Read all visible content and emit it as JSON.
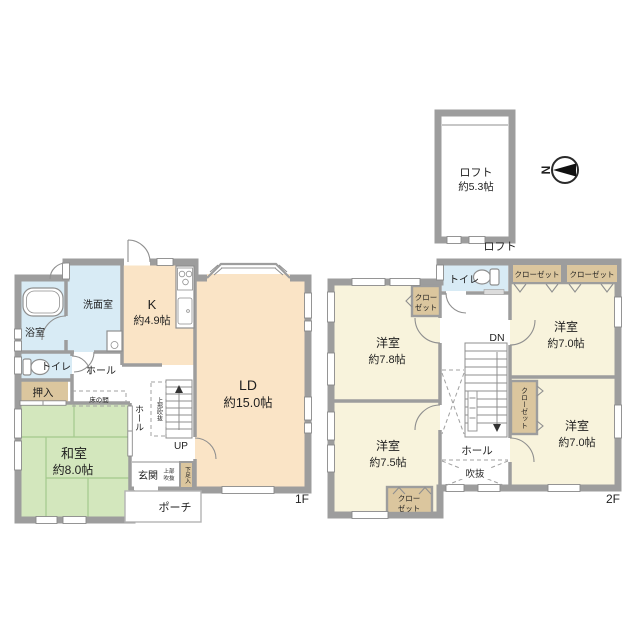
{
  "floor1": {
    "floor_label": "1F",
    "bathroom": "浴室",
    "washroom": "洗面室",
    "toilet": "トイレ",
    "closet": "押入",
    "hall": "ホール",
    "tokonoma": "床の間",
    "kitchen_label": "K",
    "kitchen_size": "約4.9帖",
    "ld_label": "LD",
    "ld_size": "約15.0帖",
    "washitsu_label": "和室",
    "washitsu_size": "約8.0帖",
    "stair_hall": "ホール",
    "stair_void": "上部吹抜",
    "up_label": "UP",
    "entrance": "玄関",
    "entrance_void_line1": "上部",
    "entrance_void_line2": "吹抜",
    "shoe_cabinet": "下足入",
    "porch": "ポーチ"
  },
  "floor2": {
    "floor_label": "2F",
    "toilet": "トイレ",
    "closet_top_a": "クローゼット",
    "closet_top_b": "クローゼット",
    "closet_left_line1": "クロー",
    "closet_left_line2": "ゼット",
    "closet_mid": "クローゼット",
    "closet_bottom_line1": "クロー",
    "closet_bottom_line2": "ゼット",
    "room_nw_label": "洋室",
    "room_nw_size": "約7.8帖",
    "room_ne_label": "洋室",
    "room_ne_size": "約7.0帖",
    "room_se_label": "洋室",
    "room_se_size": "約7.0帖",
    "room_sw_label": "洋室",
    "room_sw_size": "約7.5帖",
    "dn_label": "DN",
    "hall": "ホール",
    "void": "吹抜"
  },
  "loft": {
    "name": "ロフト",
    "size": "約5.3帖",
    "caption": "ロフト"
  },
  "compass": {
    "north": "N"
  },
  "colors": {
    "wall": "#9d9d9d",
    "warm_room": "#fae4c6",
    "tatami": "#d3e7bd",
    "wet_room": "#d8ebf5",
    "storage": "#dbc69e",
    "west_room": "#f8f3dc"
  }
}
